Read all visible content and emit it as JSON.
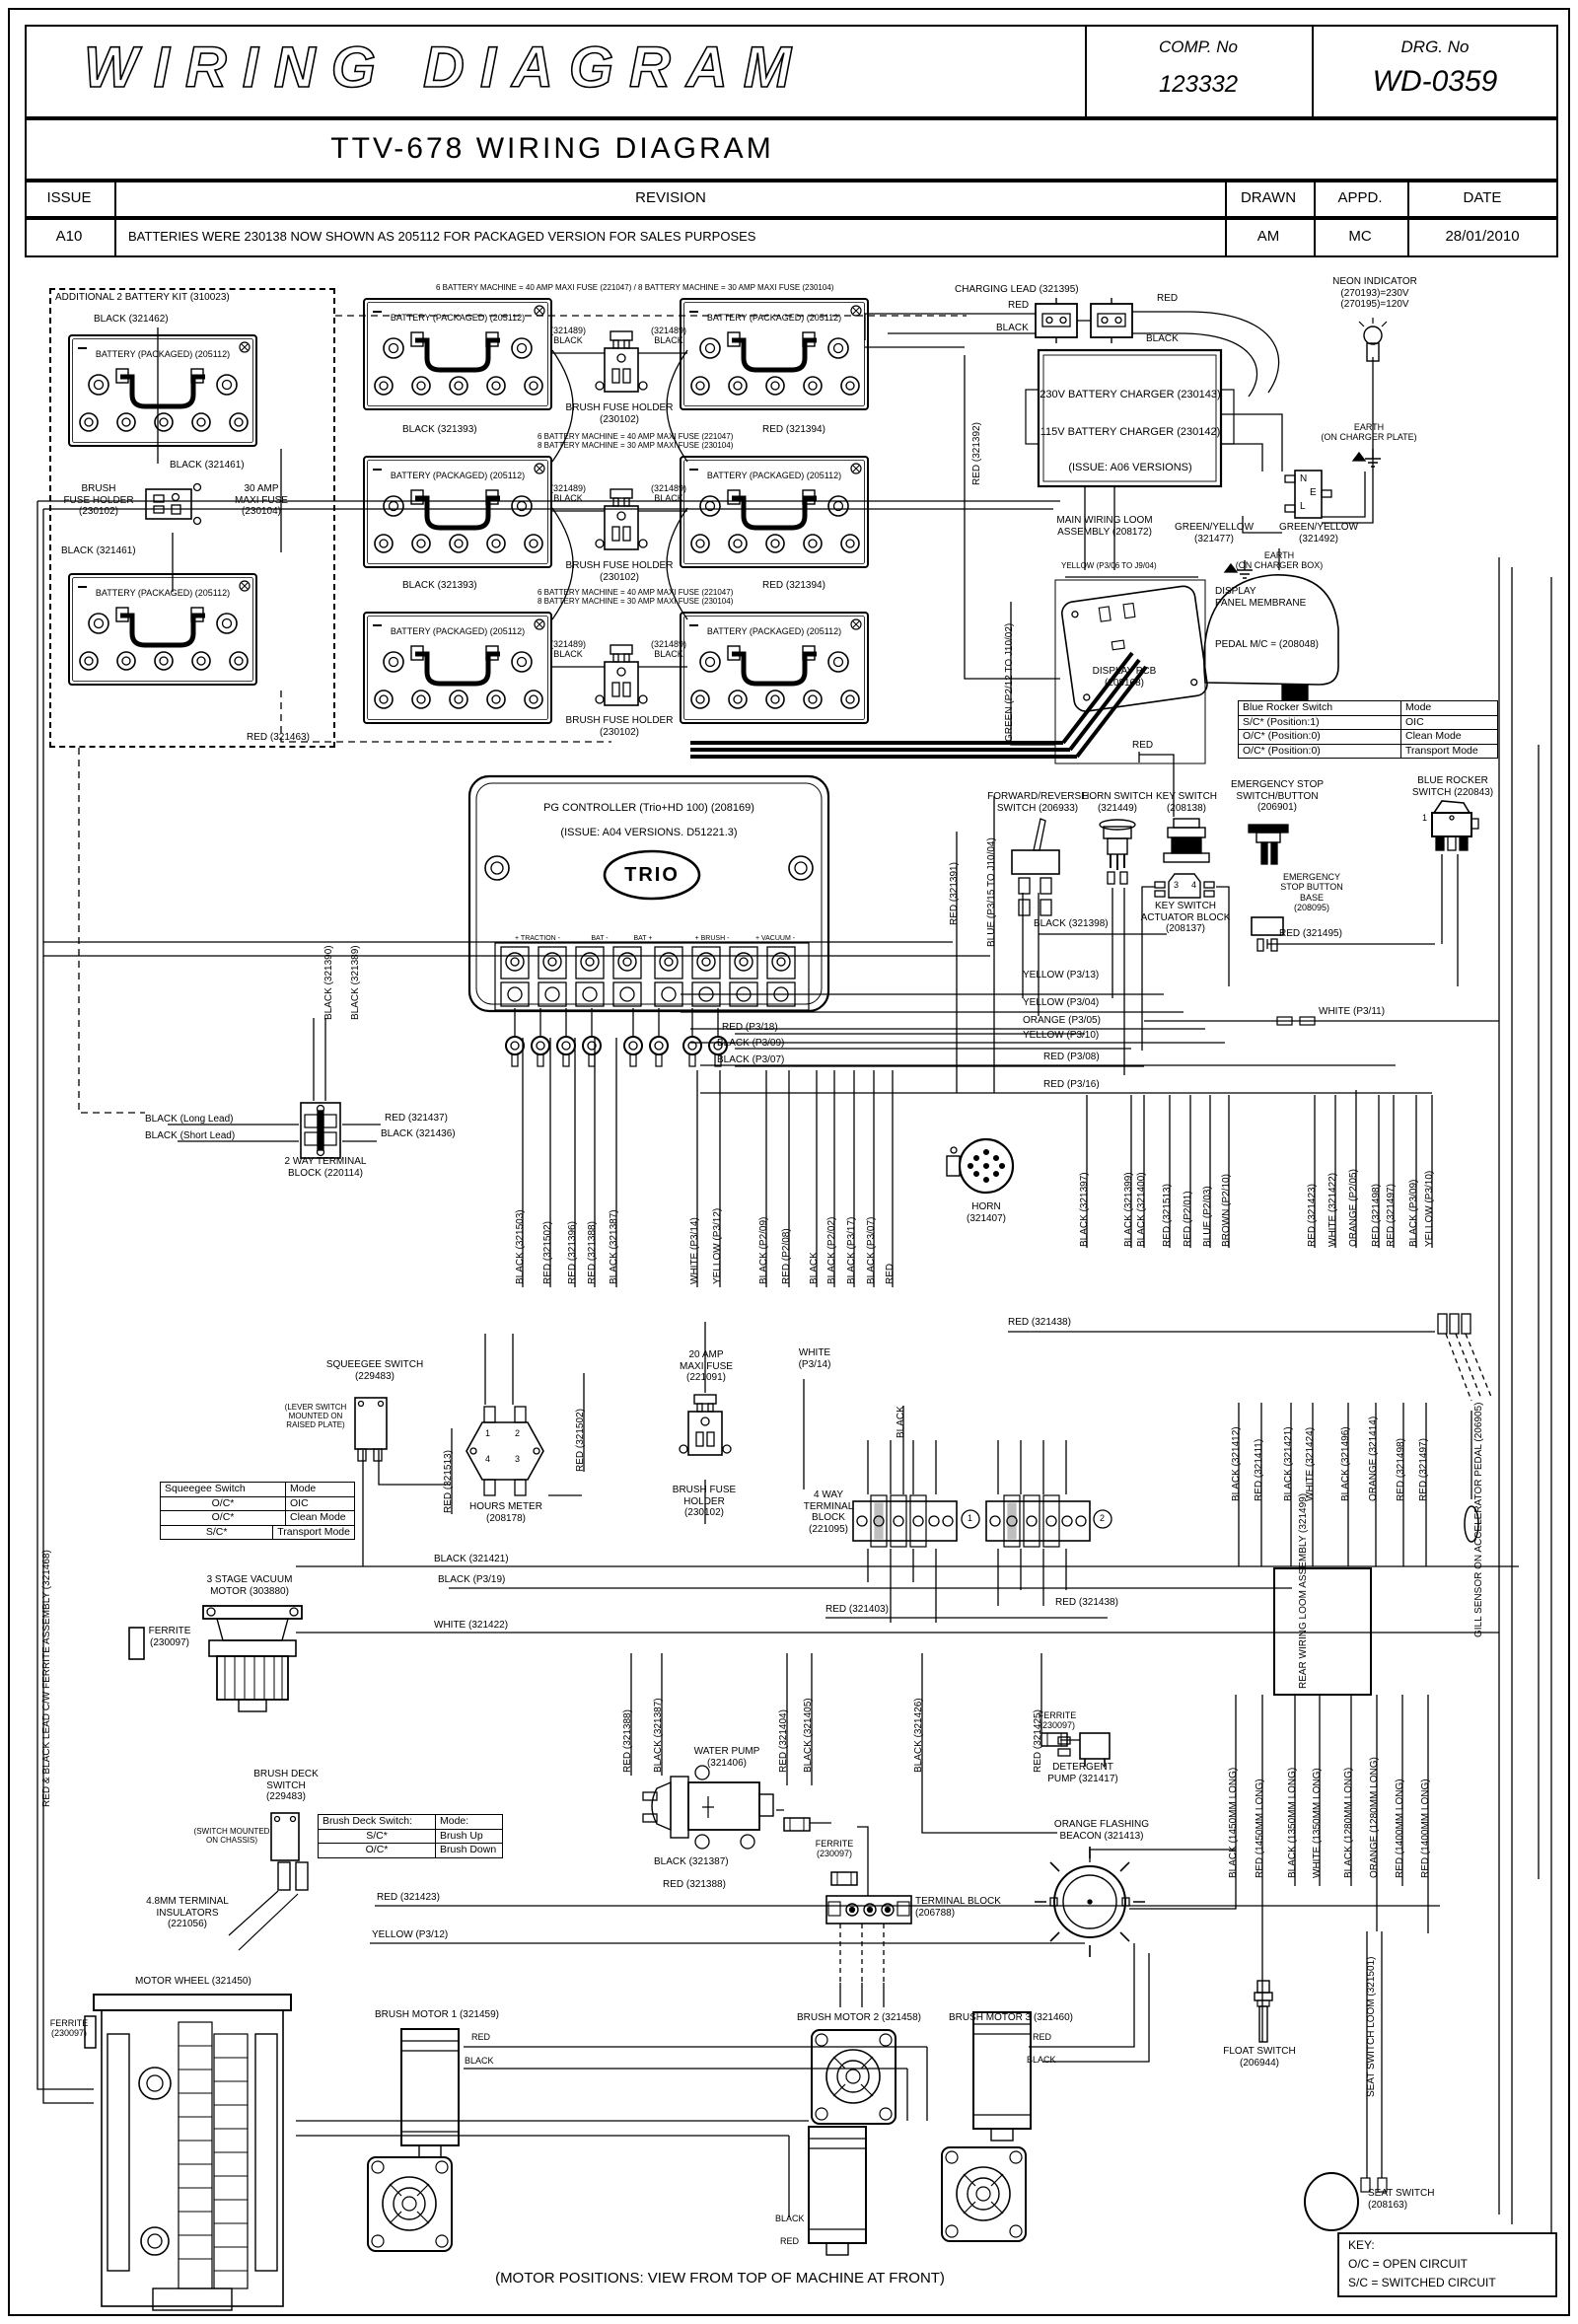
{
  "header": {
    "title": "WIRING DIAGRAM",
    "comp_label": "COMP. No",
    "comp_value": "123332",
    "drg_label": "DRG. No",
    "drg_value": "WD-0359",
    "subtitle": "TTV-678 WIRING DIAGRAM",
    "col_issue": "ISSUE",
    "col_revision": "REVISION",
    "col_drawn": "DRAWN",
    "col_appd": "APPD.",
    "col_date": "DATE",
    "issue": "A10",
    "revision": "BATTERIES WERE 230138 NOW SHOWN AS 205112 FOR PACKAGED VERSION FOR SALES PURPOSES",
    "drawn": "AM",
    "appd": "MC",
    "date": "28/01/2010"
  },
  "c": {
    "kit_title": "ADDITIONAL 2 BATTERY KIT (310023)",
    "bat_label": "BATTERY (PACKAGED) (205112)",
    "bfh": "BRUSH\nFUSE HOLDER\n(230102)",
    "maxi30": "30 AMP\nMAXI FUSE\n(230104)",
    "bfh_c": "BRUSH FUSE HOLDER\n(230102)",
    "charging_lead": "CHARGING LEAD (321395)",
    "charger1": "230V BATTERY CHARGER (230143)",
    "charger2": "115V BATTERY CHARGER (230142)",
    "charger3": "(ISSUE: A06 VERSIONS)",
    "neon": "NEON INDICATOR\n(270193)=230V\n(270195)=120V",
    "earth_plate": "EARTH\n(ON CHARGER PLATE)",
    "earth_box": "EARTH\n(ON CHARGER BOX)",
    "gy477": "GREEN/YELLOW\n(321477)",
    "gy492": "GREEN/YELLOW\n(321492)",
    "nel_n": "N",
    "nel_e": "E",
    "nel_l": "L",
    "mwl": "MAIN WIRING LOOM\nASSEMBLY (208172)",
    "display_pcb": "DISPLAY PCB\n(208168)",
    "membrane1": "DISPLAY\nPANEL MEMBRANE",
    "membrane2": "PEDAL M/C = (208048)",
    "fwdrev": "FORWARD/REVERSE\nSWITCH (206933)",
    "horn_sw": "HORN SWITCH\n(321449)",
    "key_sw": "KEY SWITCH\n(208138)",
    "key_act": "KEY SWITCH\nACTUATOR BLOCK\n(208137)",
    "estop": "EMERGENCY STOP\nSWITCH/BUTTON\n(206901)",
    "estop_base": "EMERGENCY\nSTOP BUTTON\nBASE\n(208095)",
    "bluerocker": "BLUE ROCKER\nSWITCH (220843)",
    "one": "1",
    "three": "3",
    "four": "4",
    "pg1": "PG CONTROLLER (Trio+HD 100) (208169)",
    "pg2": "(ISSUE: A04 VERSIONS. D51221.3)",
    "trio": "TRIO",
    "t_traction": "+ TRACTION -",
    "t_batm": "BAT -",
    "t_batp": "BAT +",
    "t_brush": "+ BRUSH -",
    "t_vac": "+ VACUUM -",
    "horn": "HORN\n(321407)",
    "twoway": "2 WAY TERMINAL\nBLOCK (220114)",
    "squeegee_sw": "SQUEEGEE SWITCH\n(229483)",
    "lever_note": "(LEVER SWITCH\nMOUNTED ON\nRAISED PLATE)",
    "hours": "HOURS METER\n(208178)",
    "h1": "1",
    "h2": "2",
    "h3": "3",
    "h4": "4",
    "maxi20": "20 AMP\nMAXI FUSE\n(221091)",
    "bfh2": "BRUSH FUSE\nHOLDER\n(230102)",
    "white_p314b": "WHITE\n(P3/14)",
    "vac_motor": "3 STAGE VACUUM\nMOTOR (303880)",
    "ferrite": "FERRITE\n(230097)",
    "fourway": "4 WAY\nTERMINAL\nBLOCK\n(221095)",
    "c1": "1",
    "c2": "2",
    "rear_loom": "REAR WIRING LOOM\nASSEMBLY (321499)",
    "brushdeck_sw": "BRUSH DECK\nSWITCH\n(229483)",
    "chassis_note": "(SWITCH MOUNTED\nON CHASSIS)",
    "insulators": "4.8MM TERMINAL\nINSULATORS\n(221056)",
    "water_pump": "WATER PUMP\n(321406)",
    "detergent": "DETERGENT\nPUMP (321417)",
    "beacon": "ORANGE FLASHING\nBEACON (321413)",
    "tblock": "TERMINAL BLOCK\n(206788)",
    "motor_wheel": "MOTOR WHEEL (321450)",
    "bm1": "BRUSH MOTOR 1 (321459)",
    "bm2": "BRUSH MOTOR 2 (321458)",
    "bm3": "BRUSH MOTOR 3 (321460)",
    "float_sw": "FLOAT SWITCH\n(206944)",
    "seat_sw": "SEAT SWITCH\n(208163)",
    "motor_pos": "(MOTOR POSITIONS: VIEW FROM TOP OF MACHINE AT FRONT)"
  },
  "notes": {
    "note1": "6 BATTERY MACHINE = 40 AMP MAXI FUSE (221047) / 8 BATTERY MACHINE = 30 AMP MAXI FUSE (230104)",
    "note2": "6 BATTERY MACHINE = 40 AMP MAXI FUSE (221047)\n8 BATTERY MACHINE = 30 AMP MAXI FUSE (230104)"
  },
  "w": {
    "red": "RED",
    "black": "BLACK",
    "black321462": "BLACK (321462)",
    "black321461": "BLACK (321461)",
    "red321463": "RED (321463)",
    "black321393": "BLACK (321393)",
    "red321394": "RED (321394)",
    "c321489": "(321489)\nBLACK",
    "red321392": "RED (321392)",
    "red321391": "RED (321391)",
    "green_p212": "GREEN (P2/12 TO J10/02)",
    "blue_p315": "BLUE (P3/15 TO J10/04)",
    "yellow_p306": "YELLOW (P3/06 TO J9/04)",
    "black321398": "BLACK (321398)",
    "red321495": "RED (321495)",
    "yellow_p313": "YELLOW (P3/13)",
    "yellow_p304": "YELLOW (P3/04)",
    "orange_p305": "ORANGE (P3/05)",
    "yellow_p310": "YELLOW (P3/10)",
    "red_p308": "RED (P3/08)",
    "red_p316": "RED (P3/16)",
    "white_p311": "WHITE (P3/11)",
    "red_p318": "RED (P3/18)",
    "black_p309": "BLACK (P3/09)",
    "black_p307": "BLACK (P3/07)",
    "black321503": "BLACK (321503)",
    "red321502": "RED (321502)",
    "red321396": "RED (321396)",
    "red321388": "RED (321388)",
    "black321387": "BLACK (321387)",
    "white_p314": "WHITE (P3/14)",
    "yellow_p312": "YELLOW (P3/12)",
    "black_p209": "BLACK (P2/09)",
    "red_p208": "RED (P2/08)",
    "black_p202": "BLACK (P2/02)",
    "black_p317": "BLACK (P3/17)",
    "black321397": "BLACK (321397)",
    "black321399": "BLACK (321399)",
    "black321400": "BLACK (321400)",
    "red321513": "RED (321513)",
    "red_p201": "RED (P2/01)",
    "blue_p203": "BLUE (P2/03)",
    "brown_p210": "BROWN (P2/10)",
    "red321423": "RED (321423)",
    "white321422": "WHITE (321422)",
    "orange_p205": "ORANGE (P2/05)",
    "red321498": "RED (321498)",
    "red321497": "RED (321497)",
    "black321390": "BLACK (321390)",
    "black321389": "BLACK (321389)",
    "black_long": "BLACK (Long Lead)",
    "black_short": "BLACK (Short Lead)",
    "red321437": "RED (321437)",
    "black321436": "BLACK (321436)",
    "black321421": "BLACK (321421)",
    "black_p319": "BLACK (P3/19)",
    "red321403": "RED (321403)",
    "red321438": "RED (321438)",
    "black321412": "BLACK (321412)",
    "red321411": "RED (321411)",
    "white321424": "WHITE (321424)",
    "black321496": "BLACK (321496)",
    "orange321414": "ORANGE (321414)",
    "black1450": "BLACK (1450MM LONG)",
    "red1450": "RED (1450MM LONG)",
    "black1350": "BLACK (1350MM LONG)",
    "white1350": "WHITE (1350MM LONG)",
    "black1280": "BLACK (1280MM LONG)",
    "orange1280": "ORANGE (1280MM LONG)",
    "red1400": "RED (1400MM LONG)",
    "red321404": "RED (321404)",
    "black321405": "BLACK (321405)",
    "black321426": "BLACK (321426)",
    "red321425": "RED (321425)",
    "redblack_lead": "RED & BLACK LEAD  C/W FERRITE ASSEMBLY (321468)",
    "gill": "GILL SENSOR ON ACCELERATOR PEDAL (206905)",
    "seatloom": "SEAT SWITCH LOOM (321501)"
  },
  "tables": {
    "rocker": {
      "rows": [
        [
          "Blue Rocker Switch",
          "Mode"
        ],
        [
          "S/C*  (Position:1)",
          "OIC"
        ],
        [
          "O/C*  (Position:0)",
          "Clean Mode"
        ],
        [
          "O/C*  (Position:0)",
          "Transport Mode"
        ]
      ]
    },
    "squeegee": {
      "rows": [
        [
          "Squeegee Switch",
          "Mode"
        ],
        [
          "O/C*",
          "OIC"
        ],
        [
          "O/C*",
          "Clean Mode"
        ],
        [
          "S/C*",
          "Transport Mode"
        ]
      ]
    },
    "brush": {
      "rows": [
        [
          "Brush Deck Switch:",
          "Mode:"
        ],
        [
          "S/C*",
          "Brush Up"
        ],
        [
          "O/C*",
          "Brush Down"
        ]
      ]
    },
    "key": {
      "t": "KEY:",
      "l1": "O/C = OPEN CIRCUIT",
      "l2": "S/C = SWITCHED CIRCUIT"
    }
  }
}
